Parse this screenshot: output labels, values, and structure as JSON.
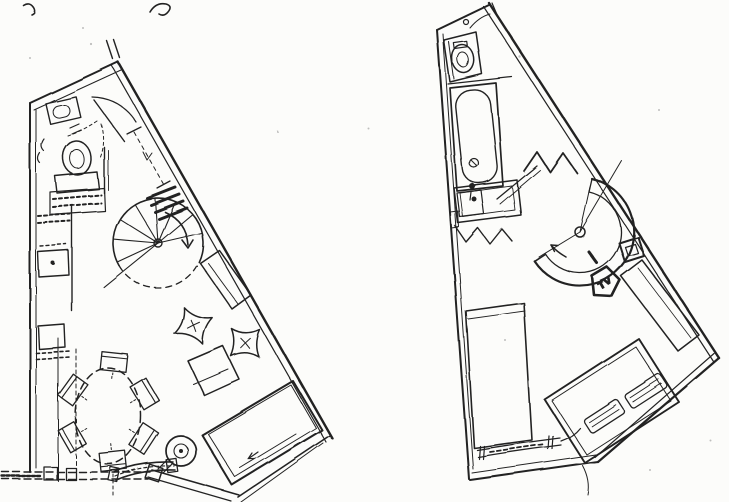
{
  "theme": {
    "paper": "#fcfcfa",
    "ink": "#232323"
  },
  "labels": {
    "tv": "TV"
  },
  "document": {
    "kind": "scanned hand-drawn duplex floor plan sketch",
    "sheets": [
      {
        "name": "lower-level-floor-plan",
        "fixtures": [
          "entry-door",
          "coat-cabinet",
          "toilet",
          "kitchen-counter",
          "sink",
          "spiral-staircase",
          "wall-shelf-dimension",
          "stair-hatch-marks",
          "wall-bench",
          "floor-cushions",
          "low-table",
          "dining-table",
          "dining-chairs",
          "sofa-bed",
          "turntable-side-table",
          "curved-bench",
          "window-band",
          "balcony-parapet"
        ]
      },
      {
        "name": "upper-level-floor-plan",
        "fixtures": [
          "toilet-room",
          "bathtub",
          "vanity-sink",
          "platform-zigzag",
          "void-zigzag",
          "handrail",
          "spiral-stair-opening",
          "tv-stand",
          "side-stool",
          "desk",
          "wardrobe",
          "double-bed",
          "pillows",
          "radiator"
        ]
      }
    ]
  }
}
